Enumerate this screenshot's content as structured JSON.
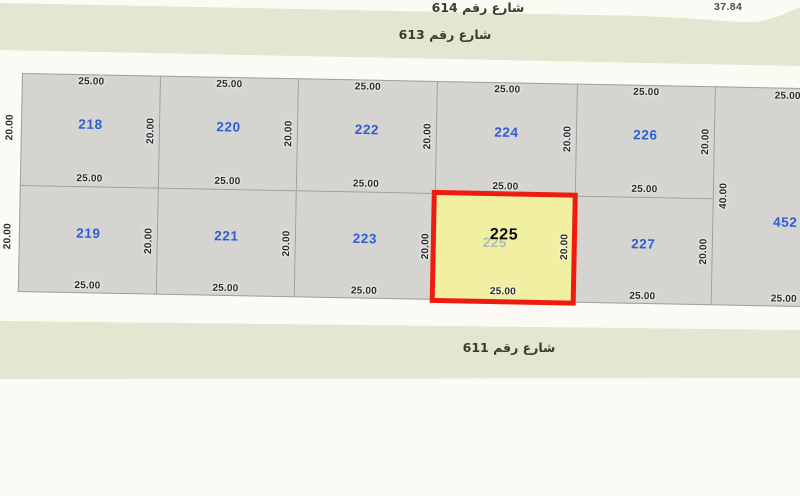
{
  "streets": {
    "s614": "شارع رقم 614",
    "s613": "شارع رقم 613",
    "s611": "شارع رقم 611"
  },
  "corner_measurement": "37.84",
  "dims": {
    "frontage": "25.00",
    "depth": "20.00",
    "tall_depth": "40.00"
  },
  "parcels": {
    "row1": [
      "218",
      "220",
      "222",
      "224",
      "226"
    ],
    "row2": [
      "219",
      "221",
      "223",
      "225",
      "227"
    ],
    "tall": "452",
    "highlighted": "225"
  },
  "colors": {
    "background": "#fbfaf4",
    "street": "#e3e6d0",
    "parcel": "#d5d4d1",
    "line": "#9f9f9b",
    "plot_number_blue": "#2e5ed6",
    "dimension_text": "#2b2b2b",
    "highlight_fill": "#f1efa2",
    "highlight_border": "#ee1c10",
    "ghost_number": "#7fa2c6",
    "street_text": "#3b3b30",
    "measure_text": "#4b4b4b"
  }
}
